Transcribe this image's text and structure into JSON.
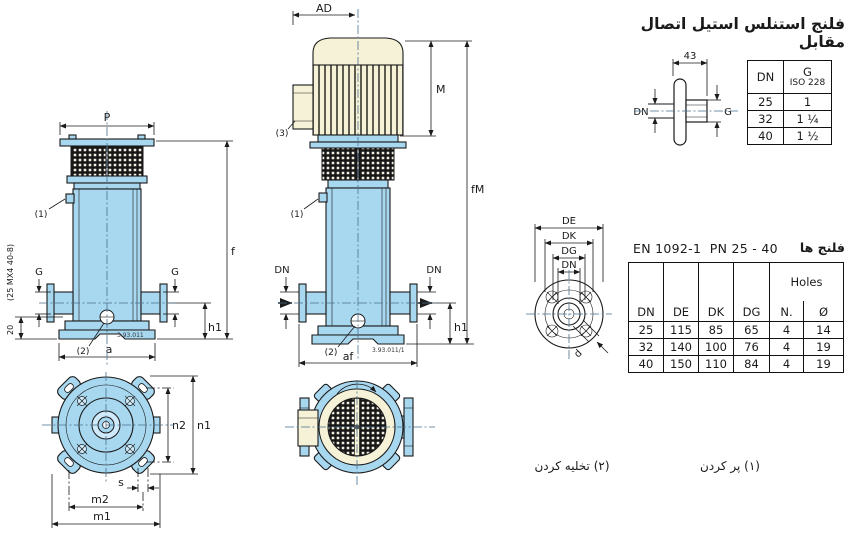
{
  "colors": {
    "pump_blue": "#a8d8f0",
    "pump_blue_light": "#cfeafa",
    "motor_cream": "#f6f2d7",
    "line": "#1a1a1a",
    "centerline": "#4a6f8f"
  },
  "left_view": {
    "labels": {
      "P": "P",
      "f": "f",
      "G_left": "G",
      "G_right": "G",
      "h1": "h1",
      "a": "a",
      "dim20": "20",
      "model_note": "(25 MX4 40-8)",
      "note1": "(1)",
      "note2": "(2)",
      "code": "3.93.011"
    }
  },
  "middle_view": {
    "labels": {
      "AD": "AD",
      "M": "M",
      "fM": "fM",
      "DN_left": "DN",
      "DN_right": "DN",
      "h1": "h1",
      "af": "af",
      "note1": "(1)",
      "note2": "(2)",
      "note3": "(3)",
      "code": "3.93.011/1"
    }
  },
  "top_view_pump": {
    "labels": {
      "n1": "n1",
      "n2": "n2",
      "s": "s",
      "m1": "m1",
      "m2": "m2"
    }
  },
  "counter_flange": {
    "title": "فلنج استنلس استیل اتصال مقابل",
    "dim_43": "43",
    "label_DN": "DN",
    "label_G": "G",
    "table": {
      "col_dn": "DN",
      "col_g": "G",
      "col_g_sub": "ISO 228",
      "rows": [
        {
          "dn": "25",
          "g": "1"
        },
        {
          "dn": "32",
          "g": "1 ¼"
        },
        {
          "dn": "40",
          "g": "1 ½"
        }
      ]
    }
  },
  "flange_section": {
    "standard": "EN 1092-1  PN 25 - 40",
    "title_fa": "فلنج ها",
    "drawing_labels": {
      "DE": "DE",
      "DK": "DK",
      "DG": "DG",
      "DN": "DN",
      "d": "d"
    },
    "table": {
      "holes": "Holes",
      "columns": [
        "DN",
        "DE",
        "DK",
        "DG",
        "N.",
        "Ø"
      ],
      "rows": [
        [
          "25",
          "115",
          "85",
          "65",
          "4",
          "14"
        ],
        [
          "32",
          "140",
          "100",
          "76",
          "4",
          "19"
        ],
        [
          "40",
          "150",
          "110",
          "84",
          "4",
          "19"
        ]
      ]
    }
  },
  "footnotes": {
    "fill": "(۱) پر کردن",
    "drain": "(۲) تخلیه کردن"
  }
}
